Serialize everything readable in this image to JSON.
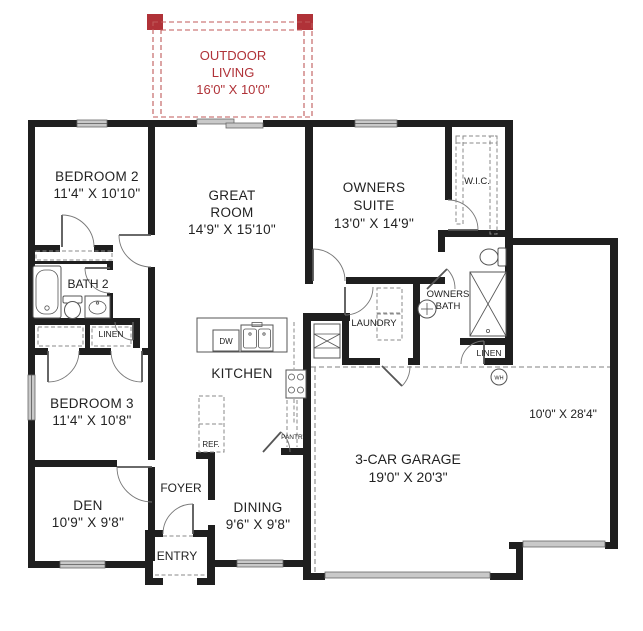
{
  "outdoor_living": {
    "line1": "OUTDOOR",
    "line2": "LIVING",
    "dims": "16'0\" X 10'0\""
  },
  "rooms": {
    "bedroom2": {
      "name": "BEDROOM 2",
      "dims": "11'4\" X 10'10\""
    },
    "great_room": {
      "line1": "GREAT",
      "line2": "ROOM",
      "dims": "14'9\" X 15'10\""
    },
    "owners_suite": {
      "line1": "OWNERS",
      "line2": "SUITE",
      "dims": "13'0\" X 14'9\""
    },
    "wic": {
      "name": "W.I.C."
    },
    "bath2": {
      "name": "BATH 2"
    },
    "linen_hall": {
      "name": "LINEN"
    },
    "bedroom3": {
      "name": "BEDROOM 3",
      "dims": "11'4\" X 10'8\""
    },
    "den": {
      "name": "DEN",
      "dims": "10'9\" X 9'8\""
    },
    "foyer": {
      "name": "FOYER"
    },
    "entry": {
      "name": "ENTRY"
    },
    "dining": {
      "name": "DINING",
      "dims": "9'6\" X 9'8\""
    },
    "kitchen": {
      "name": "KITCHEN"
    },
    "laundry": {
      "name": "LAUNDRY"
    },
    "owners_bath": {
      "line1": "OWNERS",
      "line2": "BATH"
    },
    "linen_owners": {
      "name": "LINEN"
    },
    "garage": {
      "name": "3-CAR GARAGE",
      "dims": "19'0\" X 20'3\""
    },
    "garage_bay": {
      "dims": "10'0\" X 28'4\""
    }
  },
  "fixtures": {
    "dishwasher": "DW",
    "refrigerator": "REF.",
    "pantry": "PANTRY",
    "water_heater": "WH"
  },
  "colors": {
    "wall": "#1f1f1f",
    "outdoor_accent": "#b03238",
    "window_fill": "#c9c9c9",
    "fixture_line": "#555555",
    "garage_dash": "#9a9a9a"
  }
}
